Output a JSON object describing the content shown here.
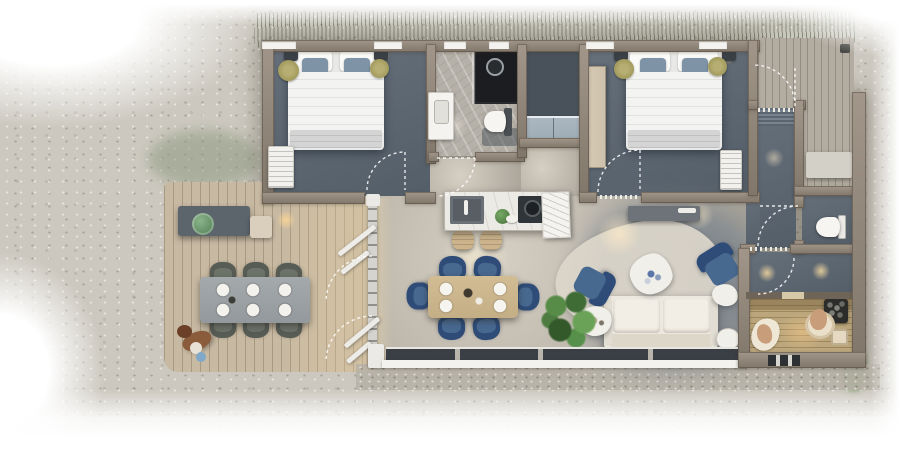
{
  "meta": {
    "type": "3d-floor-plan-rendering",
    "view": "top-down",
    "canvas_px": [
      905,
      460
    ]
  },
  "palette": {
    "gravel": "#ccc8bf",
    "gravel_dark": "#b7b2a7",
    "grass": "#5f8048",
    "shrub": "#8b9183",
    "moss": "#8e9a80",
    "wall": "#80766a",
    "wall_hi": "#a2968a",
    "wall_edge": "#6b6155",
    "slate": "#545e68",
    "slate_dark": "#49525b",
    "marble": "#b5b0a8",
    "shower_dark": "#1b1d20",
    "open_floor": "#beb8ad",
    "open_floor_hi": "#d6d0c4",
    "living_slate": "#7f878e",
    "deck_wood": "#c7b9a2",
    "deck2_wood": "#b2aca1",
    "sauna_wood": "#bca77c",
    "sauna_line": "#8f7a52",
    "duvet": "#f3f3f1",
    "blanket": "#d3d4d3",
    "pillow_blue": "#7e94a6",
    "headboard": "#3e454c",
    "rug_gold": "#a09859",
    "wardrobe": "#cdc1ac",
    "cabinet": "#9dabb5",
    "radiator_white": "#f2f1ee",
    "island_top": "#eceae5",
    "sink_grey": "#585e63",
    "stove_dark": "#303539",
    "stool_wood": "#cdb48c",
    "table_wood": "#ccb68f",
    "chair_blue": "#2e4c77",
    "chair_seat": "#47688f",
    "ochair": "#575c55",
    "otable": "#9aa0a3",
    "sofa_cream": "#ece8df",
    "rug_light": "#ddd7cb",
    "plant_green": "#4e7b40",
    "art_white": "#f4f3ef",
    "heater_dark": "#2c2c2a",
    "stone_grey": "#75756f",
    "skin": "#c89d79",
    "towel": "#efe7d6",
    "glow_warm": "#ffe3b0",
    "arc_white": "#ffffff",
    "window_white": "#f3f2ee",
    "glazing_dark": "#3a3f45",
    "mat_blue": "#5a6570"
  },
  "building": {
    "rooms": [
      {
        "id": "bedroom-left",
        "floor": "slate",
        "furniture": [
          "double-bed",
          "blue-pillows",
          "nightstands",
          "round-gold-rugs",
          "wall-radiator"
        ],
        "door_arcs": 1
      },
      {
        "id": "bathroom",
        "floor": "marble",
        "furniture": [
          "walk-in-shower",
          "wall-hung-toilet",
          "vanity-basin",
          "bath-mat"
        ],
        "door_arcs": 1
      },
      {
        "id": "closet",
        "floor": "dark",
        "furniture": [
          "low-blue-cabinet"
        ]
      },
      {
        "id": "bedroom-right",
        "floor": "slate",
        "furniture": [
          "double-bed",
          "tall-wardrobe",
          "nightstands",
          "round-gold-rugs",
          "radiator",
          "console-shelf"
        ],
        "door_arcs": 1
      },
      {
        "id": "kitchen",
        "furniture": [
          "marble-island",
          "inset-sink",
          "cooktop-with-pot",
          "herb-plant",
          "bar-stools"
        ],
        "bar_stools": 2
      },
      {
        "id": "dining",
        "furniture": [
          "wood-table",
          "blue-chairs",
          "place-settings"
        ],
        "chairs": 6,
        "plates": 4
      },
      {
        "id": "living",
        "furniture": [
          "cream-sofa",
          "organic-coffee-table",
          "blue-armchairs",
          "side-tables",
          "area-rug",
          "potted-plant",
          "leaning-artwork"
        ],
        "armchairs": 2
      },
      {
        "id": "entry-hall",
        "furniture": [
          "striped-doormat"
        ],
        "door_arcs": 1
      },
      {
        "id": "wc",
        "furniture": [
          "wall-hung-toilet"
        ],
        "door_arcs": 1
      },
      {
        "id": "corridor",
        "ceiling_lights": 2,
        "door_arcs": 1
      },
      {
        "id": "sauna",
        "furniture": [
          "tiered-benches",
          "stone-heater",
          "bucket"
        ],
        "people": 2
      }
    ],
    "outdoor": [
      {
        "id": "deck-left",
        "furniture": [
          "outdoor-dining-table",
          "outdoor-chairs",
          "storage-bench",
          "green-pot",
          "cushion-box",
          "wall-lamp"
        ],
        "chairs": 6,
        "plates": 6,
        "pet": "dog"
      },
      {
        "id": "deck-right",
        "furniture": [
          "bench"
        ]
      },
      {
        "id": "bifold-glass-doors",
        "panels": 4,
        "swing_arcs": 2
      },
      {
        "id": "lawn-strip",
        "position": "top"
      }
    ],
    "beds": 2,
    "interior_door_arcs": 6,
    "clerestory_windows": 6
  }
}
